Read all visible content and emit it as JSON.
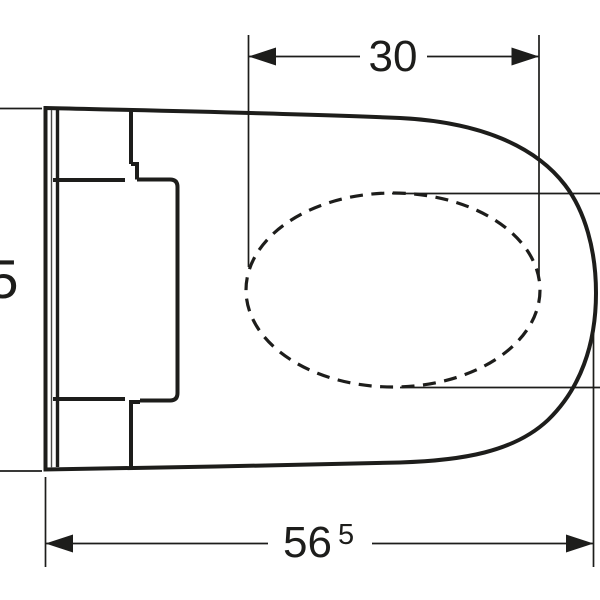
{
  "drawing": {
    "dimensions": {
      "bowl_width_top": {
        "value": "30"
      },
      "overall_depth_bottom": {
        "value": "56",
        "superscript": "5"
      },
      "left_partial": {
        "value": "5"
      }
    },
    "colors": {
      "line": "#1d1d1b",
      "background": "#ffffff"
    }
  }
}
